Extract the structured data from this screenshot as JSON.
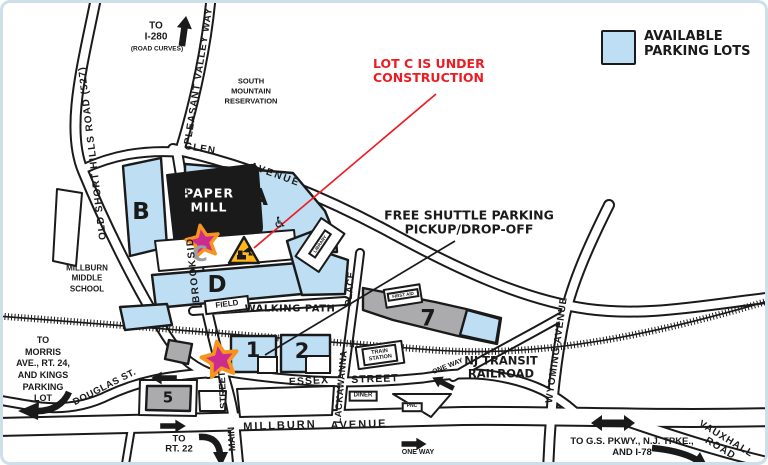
{
  "legend": {
    "label": "AVAILABLE\nPARKING LOTS"
  },
  "annotations": {
    "lot_c_construction": "LOT C IS UNDER\nCONSTRUCTION",
    "free_shuttle": "FREE SHUTTLE PARKING\nPICKUP/DROP-OFF"
  },
  "venue": {
    "name": "PAPER\nMILL"
  },
  "lots": {
    "a": "A",
    "b": "B",
    "c": "C",
    "d": "D",
    "one": "1",
    "two": "2",
    "five": "5",
    "seven": "7"
  },
  "roads": {
    "old_short_hills": "OLD SHORT HILLS ROAD (527)",
    "pleasant_valley_way": "PLEASANT VALLEY WAY",
    "glen": "GLEN",
    "glen_avenue": "AVENUE",
    "brookside_drive": "BROOKSIDE DRIVE",
    "lackawanna": "LACKAWANNA",
    "lackawanna_place": "PLACE",
    "wyoming_avenue": "WYOMING AVENUE",
    "essex": "ESSEX",
    "essex_street": "STREET",
    "millburn": "MILLBURN",
    "millburn_avenue": "AVENUE",
    "main": "MAIN",
    "main_street": "STREET",
    "douglas": "DOUGLAS ST.",
    "vauxhall": "VAUXHALL ROAD",
    "walking_path": "WALKING PATH"
  },
  "places": {
    "reservation": "SOUTH\nMOUNTAIN\nRESERVATION",
    "school": "MILLBURN\nMIDDLE\nSCHOOL",
    "field": "FIELD",
    "library": "LIBRARY",
    "first_aid": "FIRST AID",
    "train_station": "TRAIN\nSTATION",
    "diner": "DINER",
    "pnc": "PNC",
    "nj_transit": "NJ TRANSIT\nRAILROAD"
  },
  "directions": {
    "to_i280": "TO\nI-280",
    "road_curves": "(ROAD CURVES)",
    "to_morris": "TO\nMORRIS\nAVE., RT. 24,\nAND KINGS\nPARKING\nLOT",
    "to_rt22": "TO\nRT. 22",
    "to_gs_pkwy": "TO G.S. PKWY., N.J. TPKE.,\nAND I-78",
    "one_way_upper": "ONE WAY",
    "one_way_lower": "ONE WAY"
  },
  "icons": {
    "wheelchair": "♿"
  },
  "colors": {
    "available_lot": "#BDDEF3",
    "unavailable_lot": "#ABABAD",
    "construction_red": "#ED1C24",
    "star_fill": "#CE2B90",
    "star_outline": "#F7941E",
    "construction_yellow": "#FFB71B",
    "frame_border": "#CEDFEA"
  }
}
